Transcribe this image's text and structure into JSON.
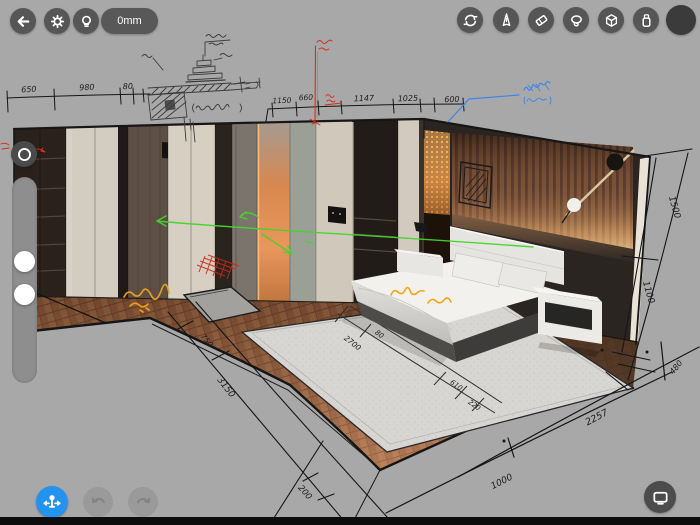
{
  "header": {
    "left": {
      "back_icon": "arrow-left",
      "settings_icon": "gear",
      "light_icon": "lightbulb",
      "measure_value": "0mm"
    },
    "right": {
      "tools": [
        "sync-rotate",
        "pen",
        "eraser",
        "lasso",
        "cube-3d",
        "marker"
      ],
      "color_swatch": "#3b3b3b"
    }
  },
  "left_panel": {
    "mode_button_icon": "ring",
    "slider_handle_count": 2
  },
  "footer": {
    "move_tool_icon": "move-gizmo",
    "undo_icon": "undo-arrow",
    "redo_icon": "redo-arrow",
    "display_icon": "display"
  },
  "canvas": {
    "scene_objects": [
      "wardrobe-wall",
      "glowing-door",
      "wood-slat-wall",
      "gold-mesh-panel",
      "wall-lamp",
      "picture-frame-sketch",
      "bed",
      "pillows",
      "nightstand",
      "side-table-lamp",
      "rug",
      "herringbone-floor",
      "pencil-detail-sketch"
    ],
    "dimensions": {
      "top_left": [
        "650",
        "980",
        "80"
      ],
      "top_center": [
        "1150",
        "660",
        "1147",
        "1025",
        "600"
      ],
      "right_wall": [
        "1500",
        "1100"
      ],
      "rug": [
        "2700",
        "80",
        "610",
        "220"
      ],
      "bottom_right": [
        "480",
        "2257",
        "1000"
      ],
      "bottom_left": [
        "750",
        "3150",
        "200"
      ]
    },
    "annotation_colors": {
      "ink": "#1a1a1a",
      "pencil": "#3c3c3c",
      "red": "#d63020",
      "green": "#44d42c",
      "blue": "#3f86e8",
      "yellow": "#e6a01a",
      "orange_text": "#f2a816"
    }
  }
}
